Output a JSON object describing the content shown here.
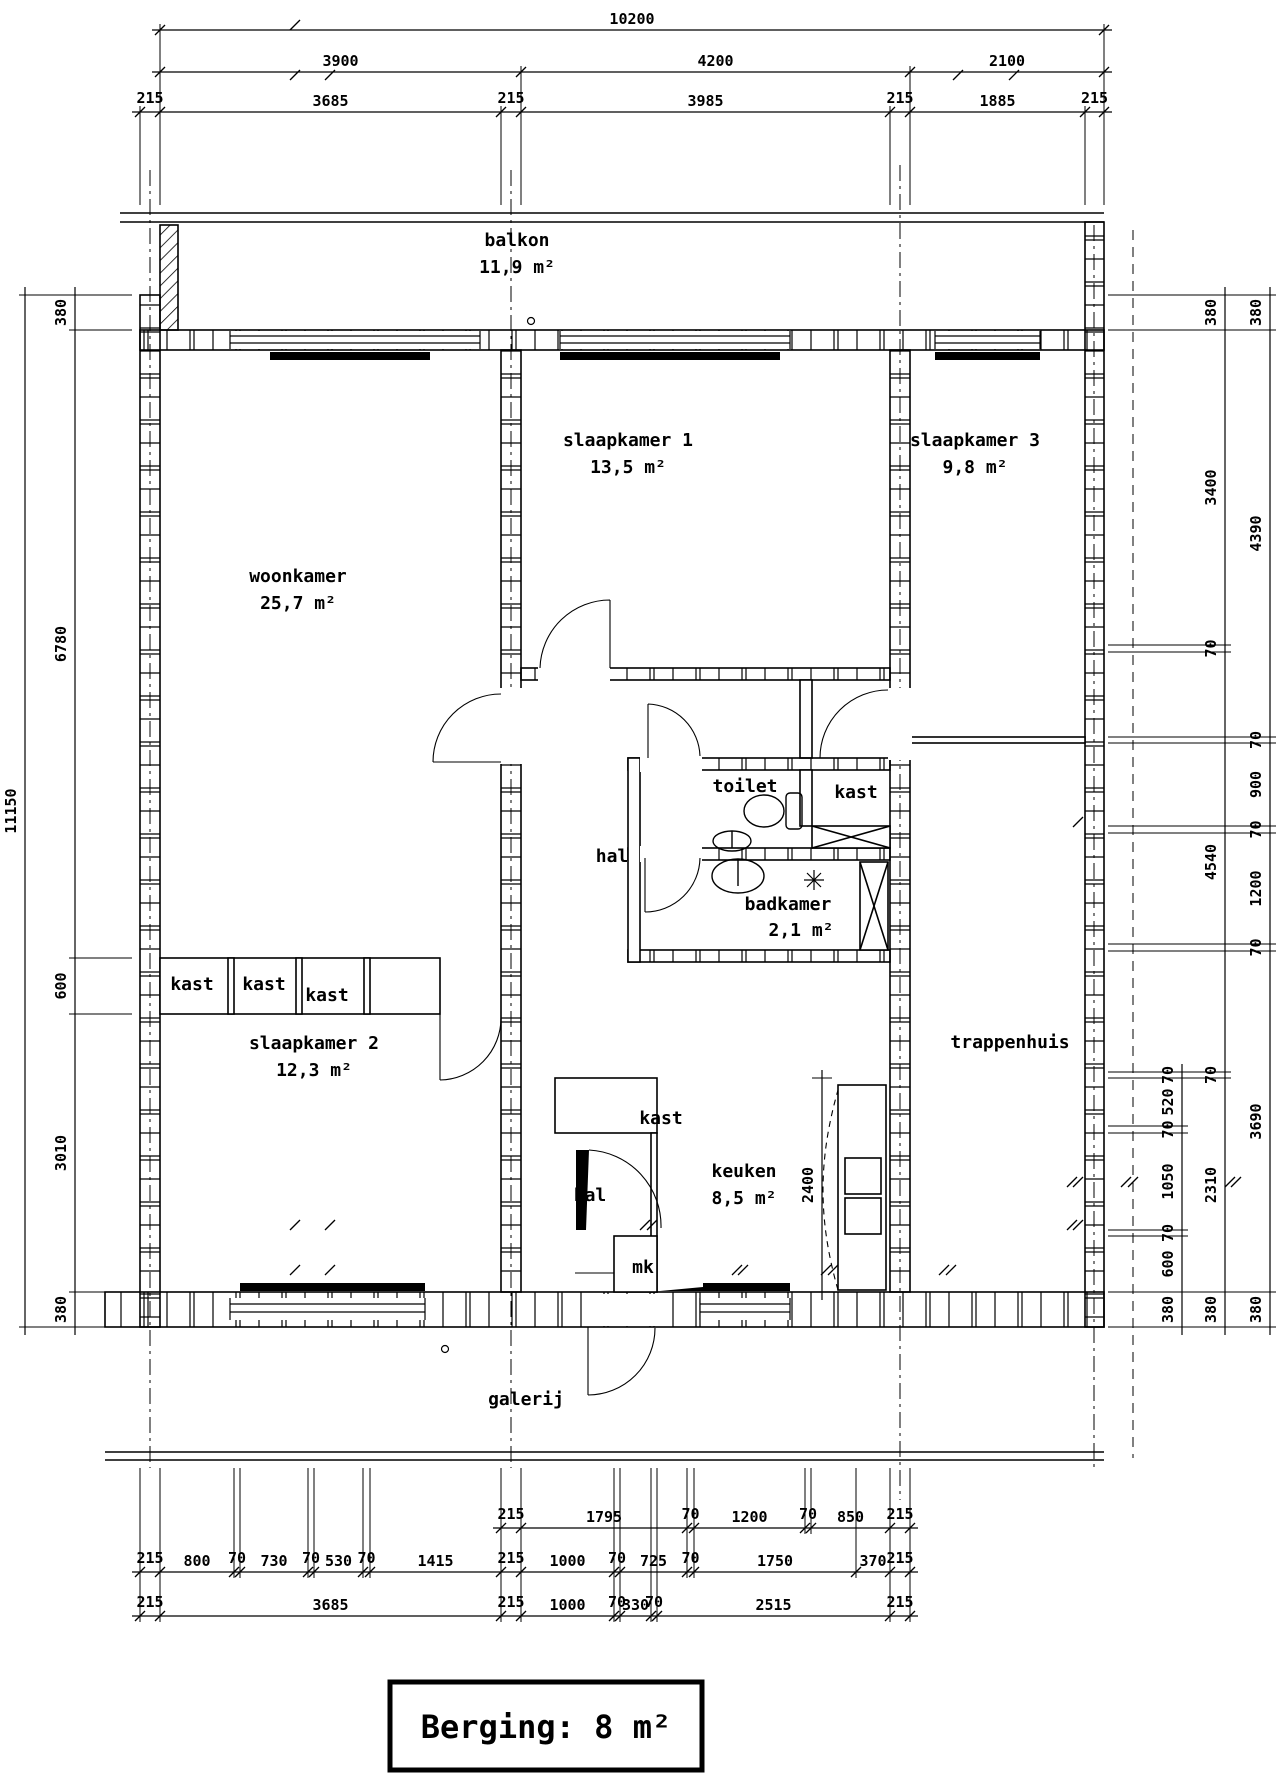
{
  "drawing": {
    "type": "floor-plan",
    "language": "nl",
    "colors": {
      "line": "#000000",
      "background": "#ffffff"
    }
  },
  "berging": {
    "label": "Berging: 8 m²"
  },
  "rooms": [
    {
      "name": "balkon",
      "area": "11,9 m²",
      "x": 517,
      "y": 246
    },
    {
      "name": "slaapkamer 1",
      "area": "13,5 m²",
      "x": 628,
      "y": 446
    },
    {
      "name": "slaapkamer 3",
      "area": "9,8 m²",
      "x": 975,
      "y": 446
    },
    {
      "name": "woonkamer",
      "area": "25,7 m²",
      "x": 298,
      "y": 582
    },
    {
      "name": "hal",
      "area": "",
      "x": 612,
      "y": 862
    },
    {
      "name": "toilet",
      "area": "",
      "x": 745,
      "y": 792
    },
    {
      "name": "kast",
      "area": "",
      "x": 856,
      "y": 798
    },
    {
      "name": "badkamer",
      "area": "",
      "x": 788,
      "y": 910
    },
    {
      "name": "2,1 m²",
      "area": "",
      "x": 801,
      "y": 936
    },
    {
      "name": "trappenhuis",
      "area": "",
      "x": 1010,
      "y": 1048
    },
    {
      "name": "kast",
      "area": "",
      "x": 192,
      "y": 990
    },
    {
      "name": "kast",
      "area": "",
      "x": 264,
      "y": 990
    },
    {
      "name": "kast",
      "area": "",
      "x": 327,
      "y": 1001
    },
    {
      "name": "slaapkamer 2",
      "area": "12,3 m²",
      "x": 314,
      "y": 1049
    },
    {
      "name": "kast",
      "area": "",
      "x": 661,
      "y": 1124
    },
    {
      "name": "hal",
      "area": "",
      "x": 590,
      "y": 1201
    },
    {
      "name": "keuken",
      "area": "8,5 m²",
      "x": 744,
      "y": 1177
    },
    {
      "name": "mk",
      "area": "",
      "x": 643,
      "y": 1273
    },
    {
      "name": "galerij",
      "area": "",
      "x": 526,
      "y": 1405
    }
  ],
  "dim_rows": [
    {
      "id": "top-overall",
      "o": "h",
      "pos": 30,
      "b": [
        160,
        1104
      ],
      "v": [
        "10200"
      ]
    },
    {
      "id": "top-bays",
      "o": "h",
      "pos": 72,
      "b": [
        160,
        521,
        910,
        1104
      ],
      "v": [
        "3900",
        "4200",
        "2100"
      ]
    },
    {
      "id": "top-detail",
      "o": "h",
      "pos": 112,
      "b": [
        140,
        160,
        501,
        521,
        890,
        910,
        1085,
        1104
      ],
      "v": [
        "215",
        "3685",
        "215",
        "3985",
        "215",
        "1885",
        "215"
      ]
    },
    {
      "id": "left-overall",
      "o": "v",
      "pos": 25,
      "b": [
        295,
        1327
      ],
      "v": [
        "11150"
      ]
    },
    {
      "id": "left-detail",
      "o": "v",
      "pos": 75,
      "b": [
        295,
        330,
        958,
        1014,
        1292,
        1327
      ],
      "v": [
        "380",
        "6780",
        "600",
        "3010",
        "380"
      ]
    },
    {
      "id": "right-inner",
      "o": "v",
      "pos": 1182,
      "b": [
        1072,
        1078,
        1126,
        1133,
        1230,
        1236,
        1292,
        1327
      ],
      "v": [
        "70",
        "520",
        "70",
        "1050",
        "70",
        "600",
        "380"
      ]
    },
    {
      "id": "right-mid",
      "o": "v",
      "pos": 1225,
      "b": [
        295,
        330,
        645,
        652,
        1072,
        1078,
        1292,
        1327
      ],
      "v": [
        "380",
        "3400",
        "70",
        "4540",
        "70",
        "2310",
        "380"
      ]
    },
    {
      "id": "right-outer",
      "o": "v",
      "pos": 1270,
      "b": [
        295,
        330,
        737,
        743,
        826,
        833,
        944,
        951,
        1292,
        1327
      ],
      "v": [
        "380",
        "4390",
        "70",
        "900",
        "70",
        "1200",
        "70",
        "3690",
        "380"
      ]
    },
    {
      "id": "bottom-1",
      "o": "h",
      "pos": 1528,
      "b": [
        501,
        521,
        687,
        694,
        805,
        811,
        890,
        910
      ],
      "v": [
        "215",
        "1795",
        "70",
        "1200",
        "70",
        "850",
        "215"
      ]
    },
    {
      "id": "bottom-2",
      "o": "h",
      "pos": 1572,
      "b": [
        140,
        160,
        234,
        240,
        308,
        314,
        363,
        370,
        501,
        521,
        614,
        620,
        687,
        694,
        856,
        890,
        910
      ],
      "v": [
        "215",
        "800",
        "70",
        "730",
        "70",
        "530",
        "70",
        "1415",
        "215",
        "1000",
        "70",
        "725",
        "70",
        "1750",
        "370",
        "215"
      ]
    },
    {
      "id": "bottom-3",
      "o": "h",
      "pos": 1616,
      "b": [
        140,
        160,
        501,
        521,
        614,
        620,
        651,
        657,
        890,
        910
      ],
      "v": [
        "215",
        "3685",
        "215",
        "1000",
        "70",
        "330",
        "70",
        "2515",
        "215"
      ]
    },
    {
      "id": "keuken-depth",
      "o": "v",
      "pos": 822,
      "interior": true,
      "b": [
        1078,
        1292
      ],
      "v": [
        "2400"
      ]
    }
  ]
}
